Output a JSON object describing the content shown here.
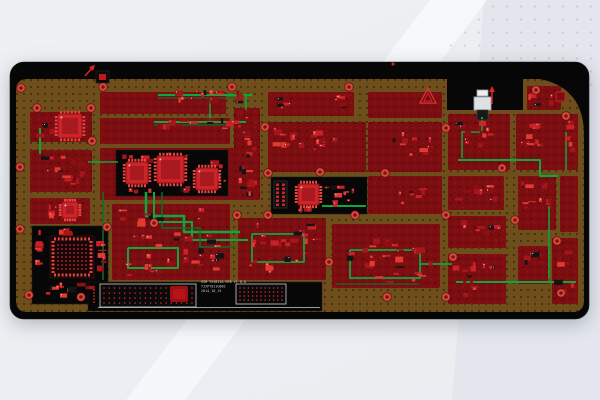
{
  "scene": {
    "description": "PCB layout board view on gradient desktop background",
    "background": {
      "base": "#eef0f4",
      "light_band": "#f7f9fb",
      "dark_corner": "#e3e7ed",
      "dot_texture": "rgba(120,135,160,0.33)"
    }
  },
  "palette": {
    "substrate": "#060606",
    "copper": "#6e4e1b",
    "copper_dot": "rgba(25,16,4,0.5)",
    "zone": "#7c0d11",
    "zone_dot": "rgba(15,0,0,0.35)",
    "trace_green": "#0fa63e",
    "trace_dark": "#0b7028",
    "red": "#e02525",
    "part_colors": [
      "#c92127",
      "#a5161b",
      "#e03a33",
      "#8c1013"
    ],
    "part_black": "#141414",
    "part_speck": "#e8d5d5",
    "ic_body": "#cd2429",
    "ic_inner": "#a81a1f",
    "ic_pin": "#e8453f",
    "via_outer": "#d94a3e",
    "via_inner": "#7e1212",
    "via_ring": "rgba(70,8,8,0.6)",
    "black": "#070707",
    "connector_white": "#dde1e4",
    "connector_tab": "#eceef0",
    "connector_stroke": "#9aa0a5",
    "box_outline": "#c9ced2",
    "dot_red": "#d22a2a"
  },
  "board": {
    "outline": {
      "x": 10,
      "y": 62,
      "w": 579,
      "h": 257,
      "r": 14
    },
    "copper": {
      "x": 16,
      "y": 79,
      "w": 568,
      "h": 233,
      "r": 10
    },
    "notch": {
      "x": 447,
      "y": 79,
      "w": 76,
      "h": 31
    },
    "corner_swoosh": "M540,79 H584 V135 Q584,88 540,79 Z"
  },
  "zones": [
    [
      30,
      112,
      62,
      30
    ],
    [
      30,
      150,
      62,
      42
    ],
    [
      30,
      198,
      60,
      26
    ],
    [
      100,
      92,
      126,
      22
    ],
    [
      100,
      118,
      130,
      26
    ],
    [
      100,
      148,
      134,
      52
    ],
    [
      112,
      204,
      118,
      76
    ],
    [
      234,
      108,
      26,
      92
    ],
    [
      268,
      92,
      86,
      24
    ],
    [
      268,
      122,
      98,
      50
    ],
    [
      238,
      218,
      88,
      62
    ],
    [
      332,
      224,
      108,
      64
    ],
    [
      368,
      92,
      74,
      26
    ],
    [
      368,
      122,
      74,
      50
    ],
    [
      368,
      176,
      74,
      38
    ],
    [
      527,
      86,
      34,
      24
    ],
    [
      448,
      114,
      62,
      56
    ],
    [
      516,
      114,
      62,
      56
    ],
    [
      448,
      176,
      56,
      34
    ],
    [
      518,
      176,
      38,
      54
    ],
    [
      560,
      176,
      18,
      56
    ],
    [
      448,
      216,
      58,
      32
    ],
    [
      518,
      246,
      30,
      38
    ],
    [
      448,
      254,
      58,
      50
    ],
    [
      552,
      238,
      26,
      66
    ]
  ],
  "black_regions": [
    [
      116,
      150,
      112,
      46
    ],
    [
      271,
      177,
      96,
      37
    ],
    [
      32,
      226,
      76,
      78
    ],
    [
      88,
      282,
      234,
      29
    ]
  ],
  "traces": [
    {
      "c": "g",
      "w": 2,
      "pts": [
        [
          158,
          95
        ],
        [
          252,
          95
        ]
      ]
    },
    {
      "c": "d",
      "w": 1.2,
      "pts": [
        [
          158,
          98
        ],
        [
          238,
          98
        ]
      ]
    },
    {
      "c": "g",
      "w": 2,
      "pts": [
        [
          154,
          122
        ],
        [
          246,
          122
        ]
      ]
    },
    {
      "c": "d",
      "w": 1.2,
      "pts": [
        [
          154,
          125
        ],
        [
          234,
          125
        ]
      ]
    },
    {
      "c": "g",
      "w": 1.5,
      "pts": [
        [
          210,
          100
        ],
        [
          210,
          120
        ]
      ]
    },
    {
      "c": "g",
      "w": 1.5,
      "pts": [
        [
          246,
          95
        ],
        [
          246,
          110
        ]
      ]
    },
    {
      "c": "g",
      "w": 2,
      "pts": [
        [
          40,
          128
        ],
        [
          40,
          154
        ]
      ]
    },
    {
      "c": "g",
      "w": 1.5,
      "pts": [
        [
          88,
          162
        ],
        [
          118,
          162
        ]
      ]
    },
    {
      "c": "g",
      "w": 2.5,
      "pts": [
        [
          146,
          192
        ],
        [
          146,
          216
        ],
        [
          184,
          216
        ],
        [
          184,
          232
        ],
        [
          240,
          232
        ]
      ]
    },
    {
      "c": "g",
      "w": 2,
      "pts": [
        [
          154,
          192
        ],
        [
          154,
          222
        ],
        [
          192,
          222
        ],
        [
          192,
          240
        ],
        [
          248,
          240
        ]
      ]
    },
    {
      "c": "d",
      "w": 1.5,
      "pts": [
        [
          162,
          192
        ],
        [
          162,
          228
        ],
        [
          200,
          228
        ],
        [
          200,
          247
        ],
        [
          236,
          247
        ]
      ]
    },
    {
      "c": "g",
      "w": 2,
      "pts": [
        [
          128,
          248
        ],
        [
          128,
          268
        ],
        [
          178,
          268
        ],
        [
          178,
          248
        ],
        [
          128,
          248
        ]
      ]
    },
    {
      "c": "g",
      "w": 1.8,
      "pts": [
        [
          252,
          234
        ],
        [
          304,
          234
        ],
        [
          304,
          262
        ],
        [
          252,
          262
        ],
        [
          252,
          234
        ]
      ]
    },
    {
      "c": "g",
      "w": 1.8,
      "pts": [
        [
          350,
          250
        ],
        [
          420,
          250
        ],
        [
          420,
          278
        ],
        [
          350,
          278
        ],
        [
          350,
          250
        ]
      ]
    },
    {
      "c": "g",
      "w": 1.8,
      "pts": [
        [
          420,
          264
        ],
        [
          452,
          264
        ]
      ]
    },
    {
      "c": "g",
      "w": 2,
      "pts": [
        [
          322,
          206
        ],
        [
          366,
          206
        ]
      ]
    },
    {
      "c": "g",
      "w": 2,
      "pts": [
        [
          458,
          160
        ],
        [
          540,
          160
        ],
        [
          540,
          176
        ],
        [
          558,
          176
        ]
      ]
    },
    {
      "c": "g",
      "w": 1.5,
      "pts": [
        [
          482,
          118
        ],
        [
          482,
          132
        ],
        [
          462,
          132
        ],
        [
          462,
          158
        ]
      ]
    },
    {
      "c": "g",
      "w": 1.5,
      "pts": [
        [
          549,
          206
        ],
        [
          549,
          278
        ]
      ]
    },
    {
      "c": "g",
      "w": 2,
      "pts": [
        [
          456,
          282
        ],
        [
          576,
          282
        ]
      ]
    },
    {
      "c": "d",
      "w": 1.2,
      "pts": [
        [
          336,
          284
        ],
        [
          420,
          284
        ]
      ]
    },
    {
      "c": "d",
      "w": 1.5,
      "pts": [
        [
          103,
          192
        ],
        [
          103,
          280
        ]
      ]
    },
    {
      "c": "g",
      "w": 1.5,
      "pts": [
        [
          566,
          132
        ],
        [
          566,
          170
        ]
      ]
    }
  ],
  "ics": [
    {
      "x": 58,
      "y": 114,
      "w": 24,
      "h": 24,
      "pins": 6
    },
    {
      "x": 62,
      "y": 202,
      "w": 16,
      "h": 16,
      "pins": 5
    },
    {
      "x": 126,
      "y": 162,
      "w": 22,
      "h": 22,
      "pins": 6
    },
    {
      "x": 157,
      "y": 156,
      "w": 27,
      "h": 27,
      "pins": 7
    },
    {
      "x": 196,
      "y": 168,
      "w": 22,
      "h": 22,
      "pins": 6
    },
    {
      "x": 298,
      "y": 184,
      "w": 21,
      "h": 21,
      "pins": 6
    }
  ],
  "bga": {
    "x": 50,
    "y": 236,
    "w": 44,
    "h": 42,
    "grid_rows": 7,
    "grid_cols": 8
  },
  "pin_connector": {
    "x": 274,
    "y": 181,
    "w": 13,
    "h": 27,
    "rows": 6,
    "cols": 2
  },
  "clusters": [
    [
      152,
      89,
      92,
      15,
      16,
      1
    ],
    [
      152,
      118,
      88,
      13,
      14,
      2
    ],
    [
      36,
      116,
      50,
      24,
      11,
      3
    ],
    [
      36,
      154,
      50,
      32,
      16,
      4
    ],
    [
      40,
      200,
      44,
      22,
      8,
      5
    ],
    [
      120,
      152,
      104,
      12,
      10,
      6
    ],
    [
      210,
      156,
      16,
      36,
      7,
      7
    ],
    [
      124,
      186,
      84,
      8,
      6,
      8
    ],
    [
      236,
      110,
      22,
      88,
      22,
      9
    ],
    [
      272,
      126,
      44,
      26,
      12,
      10
    ],
    [
      306,
      130,
      32,
      22,
      9,
      11
    ],
    [
      330,
      93,
      24,
      16,
      6,
      12
    ],
    [
      276,
      97,
      18,
      12,
      5,
      13
    ],
    [
      392,
      128,
      44,
      30,
      12,
      14
    ],
    [
      398,
      184,
      34,
      22,
      8,
      15
    ],
    [
      452,
      118,
      44,
      36,
      14,
      16
    ],
    [
      518,
      122,
      34,
      30,
      10,
      17
    ],
    [
      452,
      180,
      46,
      28,
      10,
      18
    ],
    [
      520,
      180,
      32,
      46,
      12,
      19
    ],
    [
      452,
      220,
      50,
      24,
      10,
      20
    ],
    [
      520,
      250,
      26,
      22,
      7,
      21
    ],
    [
      452,
      262,
      52,
      38,
      14,
      22
    ],
    [
      554,
      248,
      22,
      50,
      8,
      23
    ],
    [
      118,
      208,
      108,
      68,
      40,
      24
    ],
    [
      242,
      222,
      80,
      52,
      30,
      25
    ],
    [
      338,
      238,
      96,
      46,
      30,
      26
    ],
    [
      324,
      182,
      40,
      28,
      10,
      27
    ],
    [
      290,
      206,
      24,
      6,
      4,
      28
    ],
    [
      44,
      282,
      56,
      18,
      12,
      29
    ],
    [
      94,
      234,
      13,
      44,
      9,
      30
    ],
    [
      38,
      228,
      40,
      10,
      8,
      31
    ],
    [
      34,
      240,
      9,
      28,
      6,
      32
    ],
    [
      564,
      120,
      12,
      44,
      6,
      33
    ],
    [
      528,
      88,
      26,
      18,
      5,
      34
    ]
  ],
  "vias": {
    "radius": 4.3,
    "points": [
      [
        21,
        88
      ],
      [
        103,
        87
      ],
      [
        232,
        87
      ],
      [
        349,
        87
      ],
      [
        536,
        90
      ],
      [
        566,
        116
      ],
      [
        37,
        108
      ],
      [
        91,
        108
      ],
      [
        92,
        141
      ],
      [
        20,
        167
      ],
      [
        20,
        229
      ],
      [
        265,
        127
      ],
      [
        268,
        173
      ],
      [
        320,
        172
      ],
      [
        385,
        173
      ],
      [
        446,
        128
      ],
      [
        502,
        168
      ],
      [
        237,
        215
      ],
      [
        268,
        215
      ],
      [
        355,
        215
      ],
      [
        446,
        215
      ],
      [
        515,
        220
      ],
      [
        107,
        227
      ],
      [
        154,
        223
      ],
      [
        557,
        241
      ],
      [
        561,
        293
      ],
      [
        29,
        295
      ],
      [
        81,
        297
      ],
      [
        387,
        297
      ],
      [
        446,
        297
      ],
      [
        329,
        262
      ],
      [
        453,
        257
      ]
    ]
  },
  "fixtures": {
    "white_connector": {
      "tab": [
        477,
        90,
        11,
        6
      ],
      "body": [
        474,
        97,
        17,
        13
      ],
      "lower": [
        477,
        110,
        11,
        10
      ],
      "pad": [
        479,
        121,
        7,
        5
      ],
      "green": [
        481,
        117,
        2,
        2
      ]
    },
    "black_connector": {
      "body": [
        96,
        71,
        13,
        12
      ],
      "inner": [
        99,
        74,
        7,
        6
      ]
    },
    "triangle_marker": {
      "apex": [
        428,
        88
      ],
      "base_y": 103,
      "half": 8
    },
    "arrow_up": {
      "x": 492,
      "y_tail": 104,
      "y_head": 86
    },
    "arrow_ne": {
      "x1": 85,
      "y1": 76,
      "x2": 93,
      "y2": 67
    },
    "red_square": {
      "x": 556,
      "y": 92,
      "s": 9
    },
    "red_dot": {
      "x": 393,
      "y": 64,
      "r": 1.6
    }
  },
  "bottom_panel": {
    "boxes": [
      {
        "x": 100,
        "y": 284,
        "w": 96,
        "h": 23,
        "rows": 4,
        "cols": 18,
        "outline": true
      },
      {
        "x": 236,
        "y": 284,
        "w": 50,
        "h": 20,
        "rows": 4,
        "cols": 11,
        "outline": true
      },
      {
        "x": 90,
        "y": 286,
        "w": 8,
        "h": 20,
        "rows": 5,
        "cols": 2,
        "outline": false
      }
    ],
    "blob": {
      "x": 170,
      "y": 286,
      "w": 18,
      "h": 16
    },
    "underline": {
      "x1": 98,
      "y": 307.5,
      "x2": 320
    },
    "silkscreen": {
      "x": 201,
      "lines": [
        "GSM TX1811A RFB V1 0.0",
        "TJ2PT011U00E",
        "2014_10_15"
      ],
      "color": "#c9c9c9"
    }
  }
}
